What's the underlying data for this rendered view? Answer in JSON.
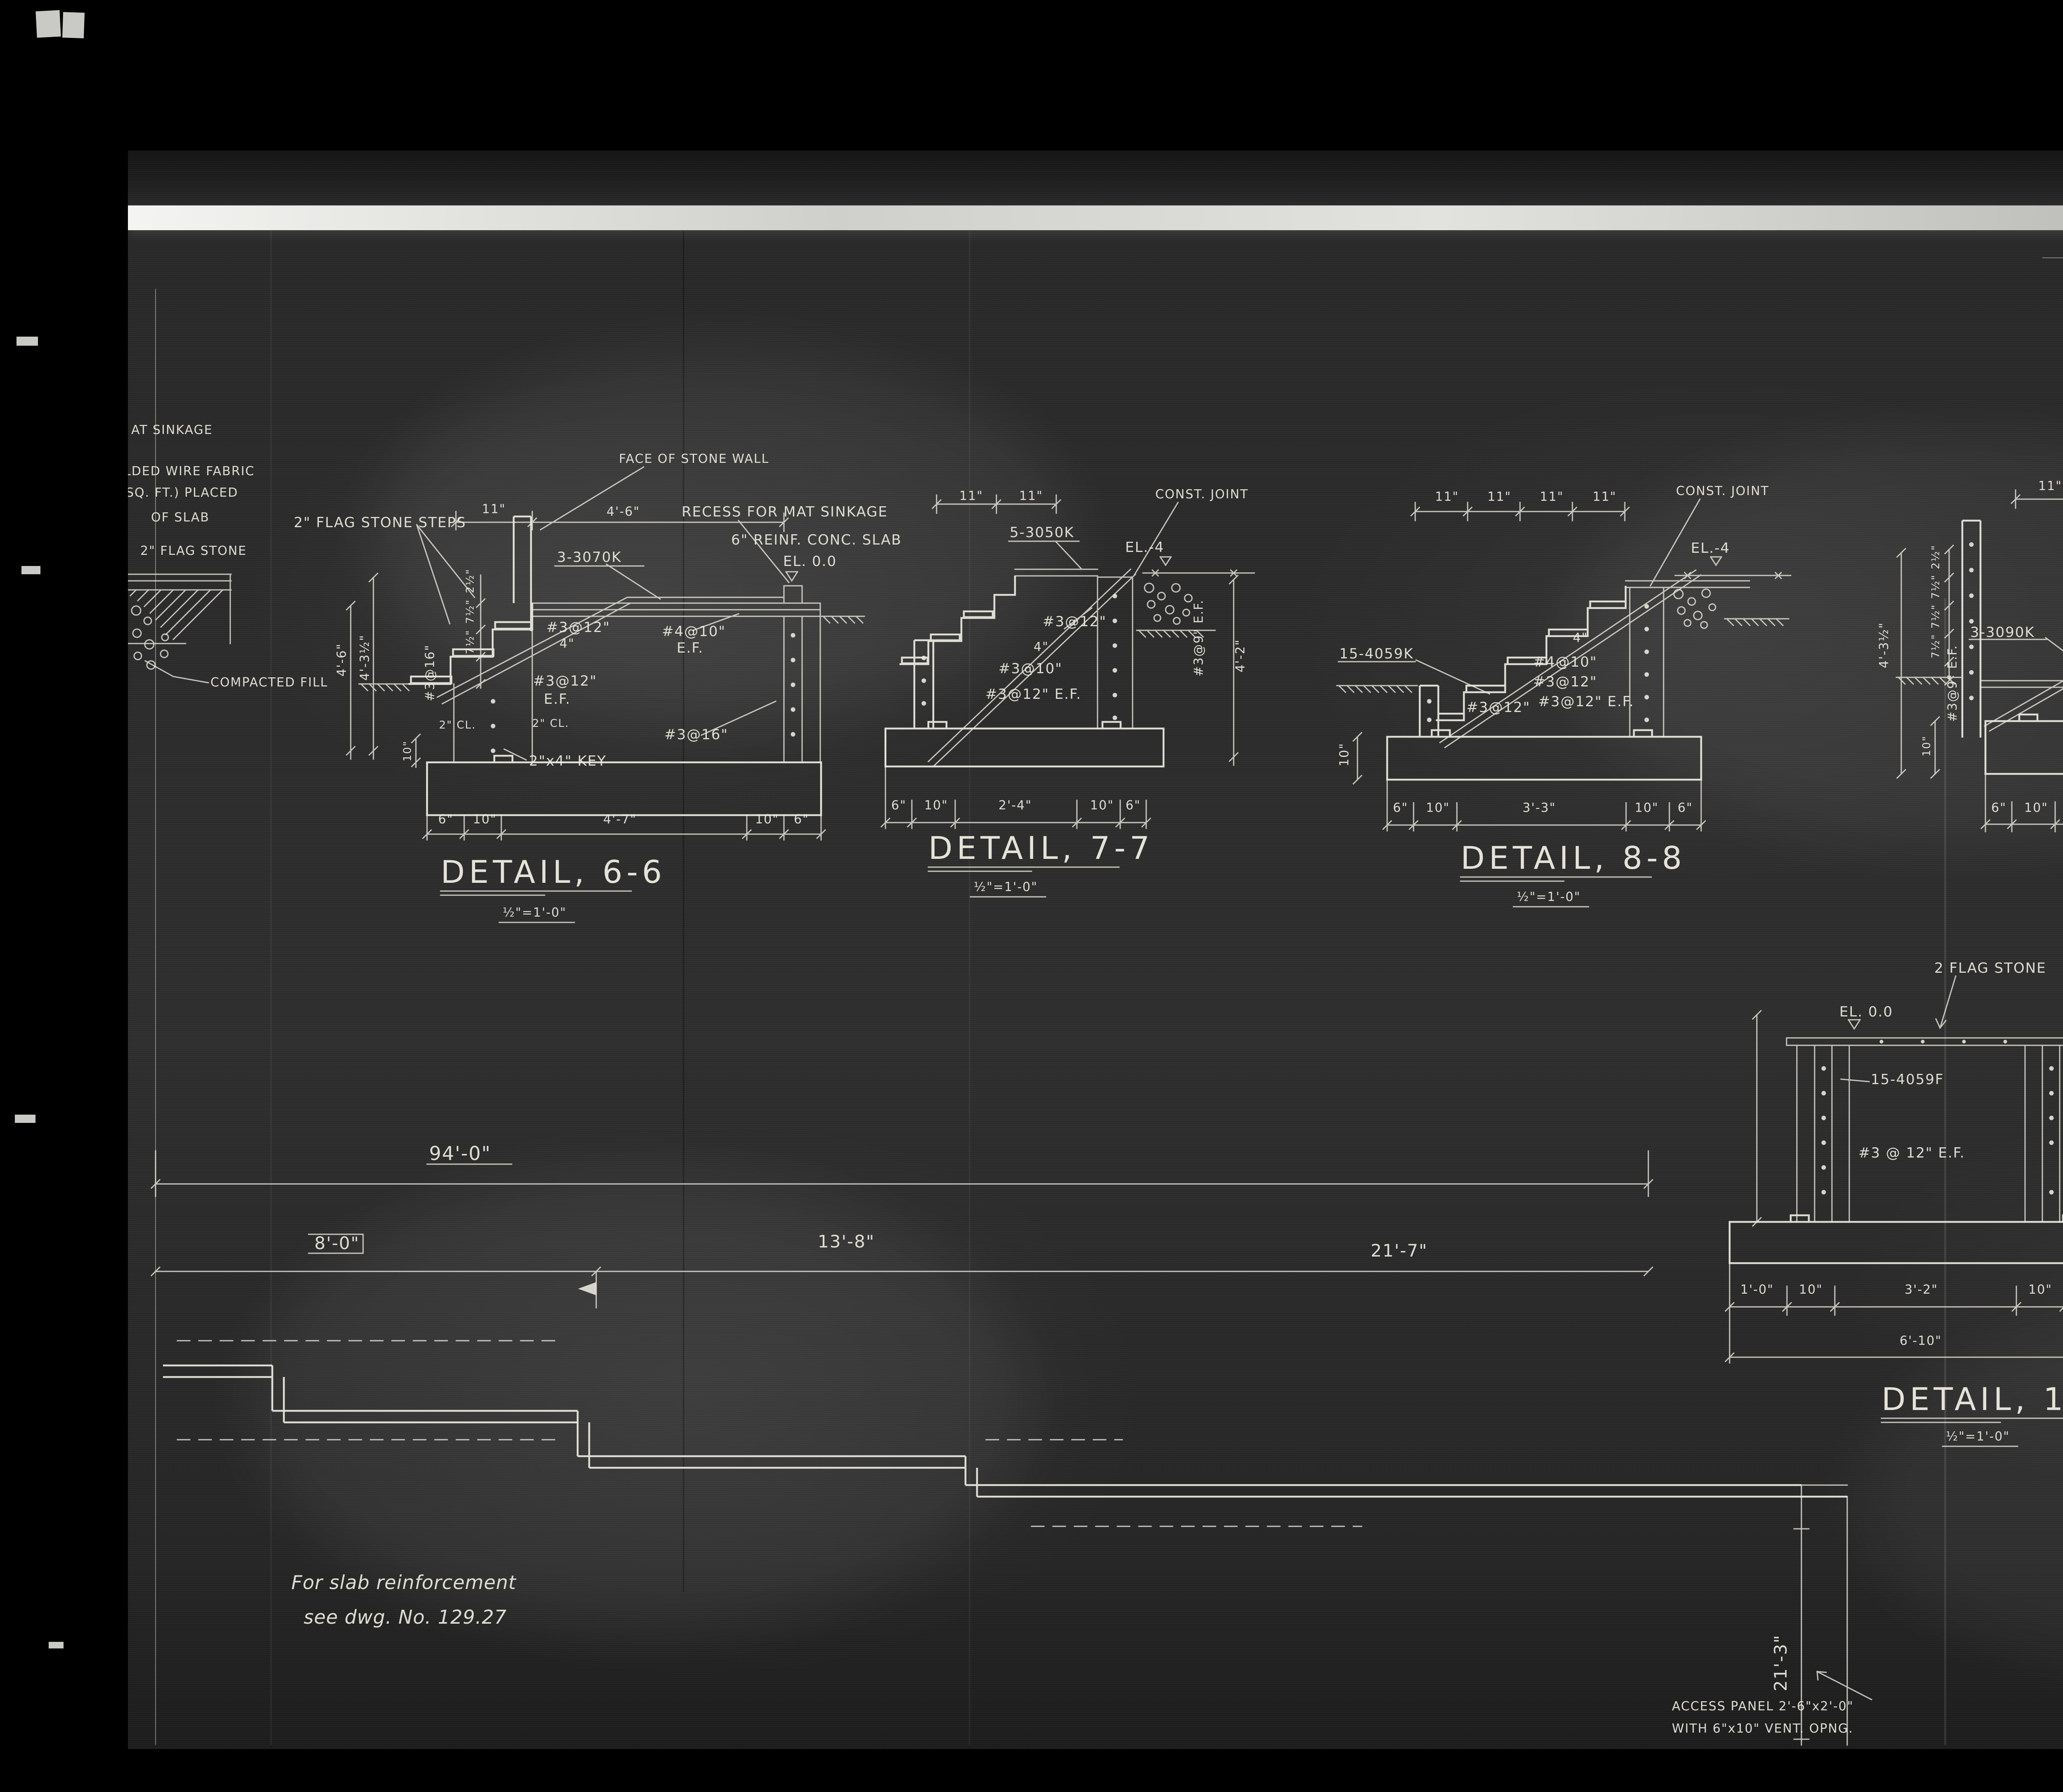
{
  "sticker": {
    "label": "2 of/de"
  },
  "margin": {
    "n1": "AT SINKAGE",
    "n2": "LDED WIRE FABRIC",
    "n3": "SQ. FT.)  PLACED",
    "n4": "OF SLAB",
    "n5": "2\" FLAG STONE",
    "n6": "COMPACTED FILL"
  },
  "d66": {
    "title": "DETAIL, 6-6",
    "scale": "½\"=1'-0\"",
    "flag_steps": "2\" FLAG STONE STEPS",
    "face": "FACE OF STONE WALL",
    "bars": "3-3070K",
    "recess": "RECESS FOR MAT SINKAGE",
    "slab": "6\" REINF. CONC. SLAB",
    "el": "EL. 0.0",
    "c1": "#4@10\"",
    "c1b": "E.F.",
    "c2": "#3@12\"",
    "c3": "4\"",
    "c4": "#3@12\"",
    "c4b": "E.F.",
    "c5": "#3@16\"",
    "c6": "#3@16\"",
    "cl1": "2\" CL.",
    "cl2": "2\" CL.",
    "key": "2\"x4\" KEY",
    "d11": "11\"",
    "d46": "4'-6\"",
    "dv1": "4'-6\"",
    "dv2": "4'-3½\"",
    "dv3": "10\"",
    "r1": "2½\"",
    "r2": "7½\"",
    "r3": "7½\"",
    "b1": "6\"",
    "b2": "10\"",
    "b3": "4'-7\"",
    "b4": "10\"",
    "b5": "6\""
  },
  "d77": {
    "title": "DETAIL, 7-7",
    "scale": "½\"=1'-0\"",
    "bars": "5-3050K",
    "el": "EL.-4",
    "joint": "CONST. JOINT",
    "c1": "#3@12\"",
    "c2": "4\"",
    "c3": "#3@10\"",
    "c4": "#3@12\" E.F.",
    "c5": "#3@9\" E.F.",
    "dv1": "4'-2\"",
    "d11a": "11\"",
    "d11b": "11\"",
    "b1": "6\"",
    "b2": "10\"",
    "b3": "2'-4\"",
    "b4": "10\"",
    "b5": "6\""
  },
  "d88": {
    "title": "DETAIL, 8-8",
    "scale": "½\"=1'-0\"",
    "bars": "15-4059K",
    "el": "EL.-4",
    "joint": "CONST. JOINT",
    "c1": "4\"",
    "c2": "#4@10\"",
    "c3": "#3@12\"",
    "c4": "#3@12\" E.F.",
    "c5": "#3@12\"",
    "dv1": "10\"",
    "d11a": "11\"",
    "d11b": "11\"",
    "d11c": "11\"",
    "d11d": "11\"",
    "b1": "6\"",
    "b2": "10\"",
    "b3": "3'-3\"",
    "b4": "10\"",
    "b5": "6\""
  },
  "d99": {
    "title": "DETAIL, 9-9",
    "scale": "½\"=1'-0\"",
    "bars": "3-3090K",
    "flag": "2\" FLAG STONE",
    "recess": "RECESS FOR MAT SINKAGE",
    "el": "EL. 0.0",
    "c1": "#4@10\" E.F.",
    "c2": "4\"",
    "c3": "#3@12\"",
    "c4": "#3@12\"",
    "c5": "#3@9\" E.F.",
    "c6": "#3@16\"",
    "c7": "#3@9\" E.F.",
    "cl1": "2\" CL.",
    "cl2": "2\" CL.",
    "d11a": "11\"",
    "d11b": "11\"",
    "d11c": "11\"",
    "d46": "4'-6\"",
    "dv1": "4'-3½\"",
    "dv2": "10\"",
    "dv3": "4'-6\"",
    "r1": "2½\"",
    "r2": "7½\"",
    "r3": "7½\"",
    "r4": "7½\"",
    "b1": "6\"",
    "b2": "10\"",
    "b3": "6'-5\"",
    "b4": "10\"",
    "b5": "6\""
  },
  "d1010": {
    "title": "DETAIL, 10-10",
    "scale": "½\"=1'-0\"",
    "flag": "2 FLAG STONE",
    "el": "EL. 0.0",
    "bars": "15-4059F",
    "c1": "#3 @ 12\" E.F.",
    "c2": "#3@9\" E.F.",
    "dv1": "4'-6\"",
    "dv2": "10\"",
    "b1": "1'-0\"",
    "b2": "10\"",
    "b3": "3'-2\"",
    "b4": "10\"",
    "b5": "1'-0\"",
    "total": "6'-10\""
  },
  "d1111": {
    "title": "DETAIL, 11-11",
    "scale": "½\"=1'-0\"",
    "el": "EL. 0.0",
    "c1": "#3@16\"",
    "c2": "#3@9\" E.F.",
    "cl1": "2\" CL.",
    "cl2": "2\" CL.",
    "dv1": "4'-6\"",
    "dv2": "10\"",
    "b1": "2'-6\"",
    "b2": "10\"",
    "b3": "6\"",
    "total": "3'-10\""
  },
  "plan": {
    "dim_total": "94'-0\"",
    "dim_a": "8'-0\"",
    "dim_b": "13'-8\"",
    "dim_c": "21'-7\"",
    "dim_d": "21'-3\"",
    "note1": "For slab reinforcement",
    "note2": "see dwg. No. 129.27",
    "access1": "ACCESS PANEL 2'-6\"x2'-0\"",
    "access2": "WITH 6\"x10\" VENT. OPNG."
  },
  "table": {
    "title": "LIST OF BENT BARS  (1 CABIN)",
    "headers": [
      "No.",
      "Size",
      "Length",
      "Mark",
      "A",
      "B",
      "C",
      "D",
      "G",
      "H"
    ],
    "rows": [
      [
        "5",
        "#3",
        "5'-0\"",
        "3050K",
        "",
        "1'-1\"",
        "3'-0\"",
        "11\"",
        "",
        "1'-7\""
      ],
      [
        "40",
        "\"",
        "7'-0\"",
        "3070F",
        "",
        "3'-6\"",
        "3'-6\"",
        "",
        "",
        ""
      ],
      [
        "3",
        "\"",
        "7'-0\"",
        "3070K",
        "9\"",
        "4'-3\"",
        "2'-0\"",
        "",
        "",
        "1'-5\""
      ],
      [
        "3",
        "\"",
        "9'-0\"",
        "3090K",
        "9\"",
        "4'-3\"",
        "4'-0\"",
        "",
        "",
        "2'-3\""
      ],
      [
        "15",
        "#4",
        "5'-9\"",
        "4059K",
        "",
        "1'-1\"",
        "4'-3\"",
        "5\"",
        "",
        "2'-4\""
      ],
      [
        "15",
        "\"",
        "5'-9\"",
        "4059F",
        "",
        "9\"",
        "4'-3\"",
        "",
        "9\"",
        ""
      ]
    ],
    "partial_row": [
      "",
      "",
      "",
      "",
      "",
      "3'-6\"",
      "3'-6\"",
      "",
      "",
      ""
    ]
  }
}
